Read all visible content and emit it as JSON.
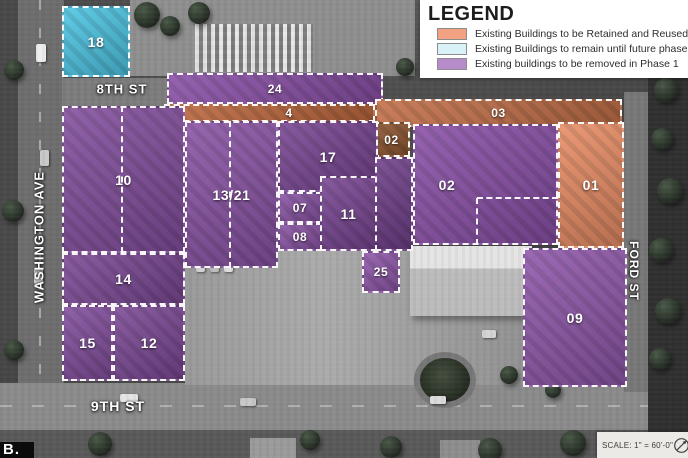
{
  "legend": {
    "title": "LEGEND",
    "items": [
      {
        "label": "Existing Buildings to be Retained and Reused",
        "color": "#f2a183",
        "status": "retained"
      },
      {
        "label": "Existing Buildings to remain until future phase",
        "color": "#d8f2f7",
        "status": "future"
      },
      {
        "label": "Existing buildings to be removed in Phase 1",
        "color": "#b78ccb",
        "status": "removed"
      }
    ]
  },
  "streets": {
    "north": "8TH ST",
    "south": "9TH ST",
    "west": "WASHINGTON AVE",
    "east": "FORD ST"
  },
  "scale_bar": {
    "text": "SCALE: 1\" = 60'-0\"",
    "icon": "north-arrow"
  },
  "logo_fragment": "B.",
  "map": {
    "overlay_colors": {
      "removed": "#8b51a8",
      "retained": "#e98e66",
      "future": "#4fc6e4"
    },
    "buildings": [
      {
        "id": "18",
        "label": "18",
        "status": "future",
        "color": "#4fc6e4",
        "x": 62,
        "y": 6,
        "w": 68,
        "h": 71
      },
      {
        "id": "24",
        "label": "24",
        "status": "removed",
        "color": "#8b51a8",
        "x": 167,
        "y": 73,
        "w": 216,
        "h": 31
      },
      {
        "id": "4",
        "label": "4",
        "status": "retained",
        "color": "#bf6a40",
        "x": 164,
        "y": 104,
        "w": 211,
        "h": 18,
        "lx": 289
      },
      {
        "id": "03",
        "label": "03",
        "status": "retained",
        "color": "#c4714a",
        "x": 375,
        "y": 99,
        "w": 247,
        "h": 28
      },
      {
        "id": "02a",
        "label": "02",
        "status": "retained",
        "color": "#8f5732",
        "x": 373,
        "y": 122,
        "w": 37,
        "h": 35
      },
      {
        "id": "02",
        "label": "02",
        "status": "removed",
        "color": "#8b51a8",
        "x": 413,
        "y": 124,
        "w": 145,
        "h": 121,
        "lx": 447
      },
      {
        "id": "01",
        "label": "01",
        "status": "retained",
        "color": "#e98e66",
        "x": 558,
        "y": 122,
        "w": 66,
        "h": 126
      },
      {
        "id": "10",
        "label": "10",
        "status": "removed",
        "color": "#84509f",
        "x": 62,
        "y": 106,
        "w": 123,
        "h": 147
      },
      {
        "id": "14",
        "label": "14",
        "status": "removed",
        "color": "#7d4a96",
        "x": 62,
        "y": 253,
        "w": 123,
        "h": 52
      },
      {
        "id": "15",
        "label": "15",
        "status": "removed",
        "color": "#84509f",
        "x": 62,
        "y": 305,
        "w": 51,
        "h": 76
      },
      {
        "id": "12",
        "label": "12",
        "status": "removed",
        "color": "#7d4a96",
        "x": 113,
        "y": 305,
        "w": 72,
        "h": 76
      },
      {
        "id": "13-21",
        "label": "13/21",
        "status": "removed",
        "color": "#8b55a6",
        "x": 185,
        "y": 121,
        "w": 93,
        "h": 147
      },
      {
        "id": "17",
        "label": "17",
        "status": "removed",
        "color": "#7a4794",
        "x": 278,
        "y": 121,
        "w": 100,
        "h": 71
      },
      {
        "id": "07",
        "label": "07",
        "status": "removed",
        "color": "#8b55a6",
        "x": 278,
        "y": 192,
        "w": 44,
        "h": 31
      },
      {
        "id": "08",
        "label": "08",
        "status": "removed",
        "color": "#8b55a6",
        "x": 278,
        "y": 223,
        "w": 44,
        "h": 28
      },
      {
        "id": "11",
        "label": "11",
        "status": "removed",
        "color": "#7a4794",
        "x": 320,
        "y": 176,
        "w": 57,
        "h": 75
      },
      {
        "id": "25",
        "label": "25",
        "status": "removed",
        "color": "#9159ab",
        "x": 362,
        "y": 251,
        "w": 38,
        "h": 42
      },
      {
        "id": "strip",
        "label": "",
        "status": "removed",
        "color": "#70418a",
        "x": 375,
        "y": 157,
        "w": 38,
        "h": 94
      },
      {
        "id": "09",
        "label": "09",
        "status": "removed",
        "color": "#9159ab",
        "x": 523,
        "y": 248,
        "w": 104,
        "h": 139
      }
    ],
    "dividers": [
      {
        "dir": "v",
        "x": 122,
        "y": 106,
        "len": 147
      },
      {
        "dir": "v",
        "x": 230,
        "y": 121,
        "len": 147
      },
      {
        "dir": "h",
        "x": 477,
        "y": 198,
        "len": 81
      },
      {
        "dir": "v",
        "x": 477,
        "y": 198,
        "len": 47
      }
    ]
  }
}
